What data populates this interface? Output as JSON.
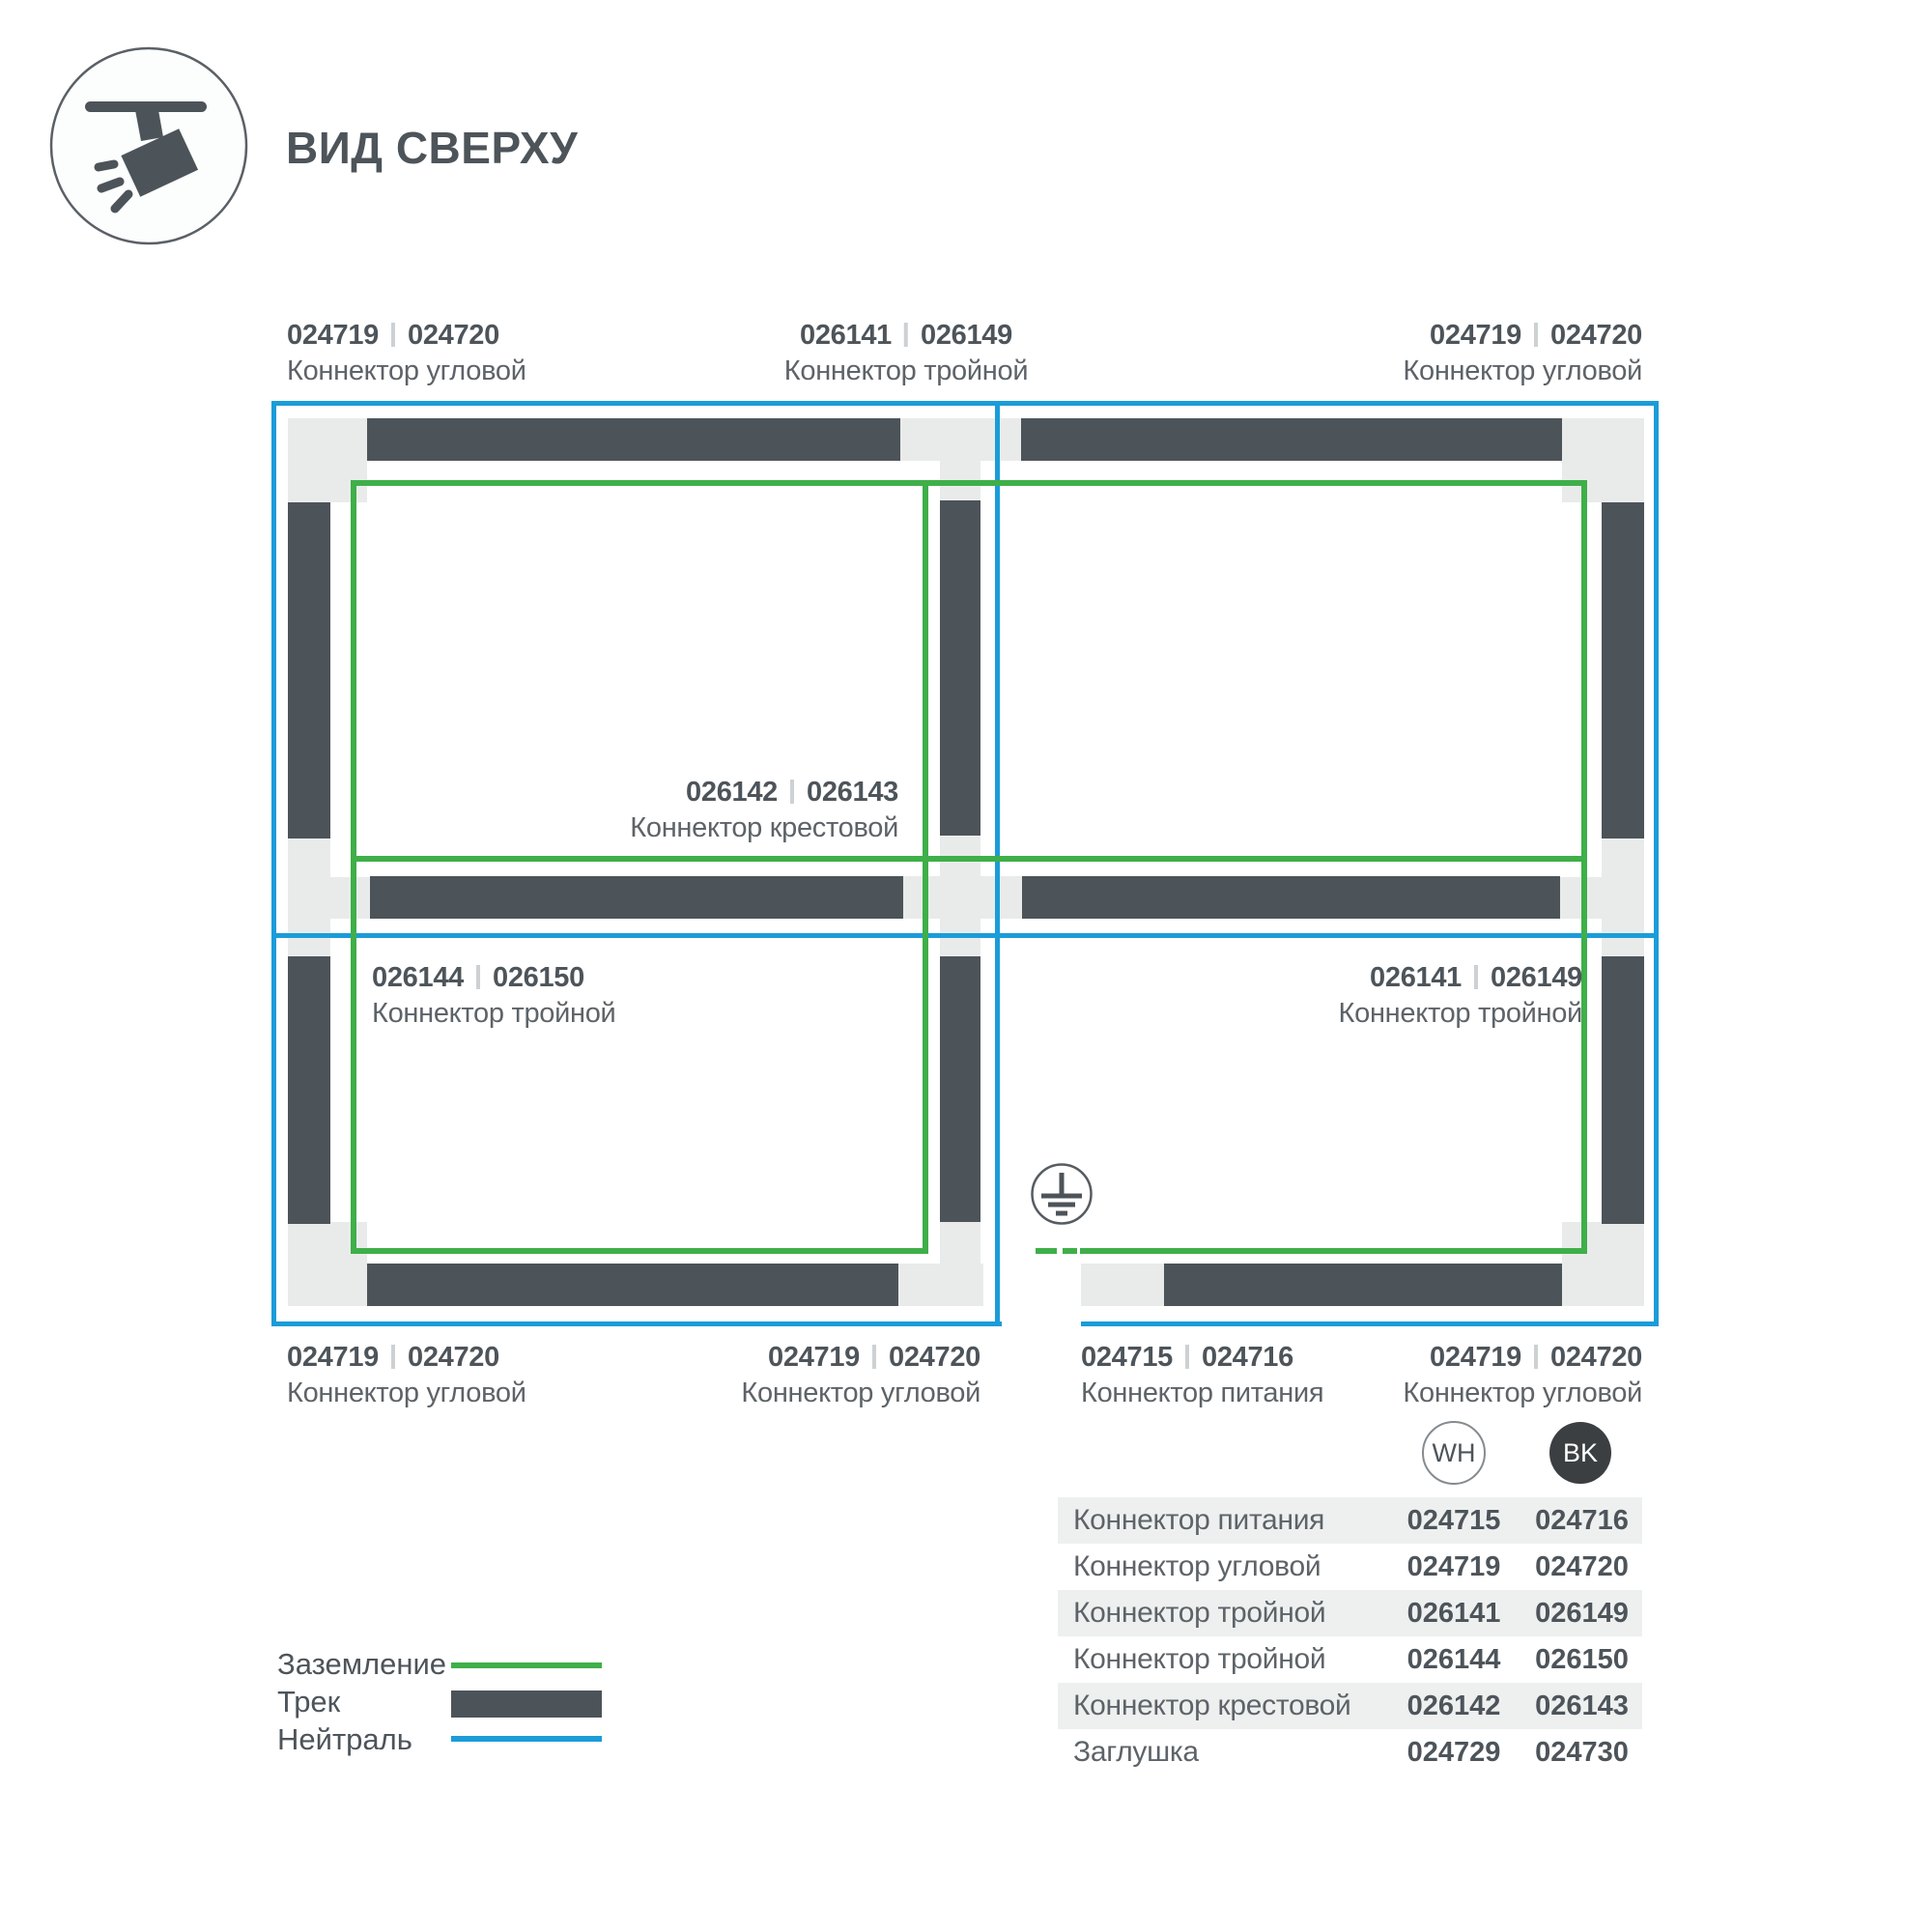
{
  "header": {
    "title": "ВИД СВЕРХУ"
  },
  "icons": {
    "header_icon": "track-spotlight-icon",
    "ground_icon": "protective-earth-icon"
  },
  "colors": {
    "track": "#4d5459",
    "connector_block": "#e9ebeb",
    "ground_green": "#3faf49",
    "neutral_blue": "#1b9cd8",
    "text_dark": "#4d545a",
    "text_caption": "#5d6368",
    "table_row_bg": "#eef0f0",
    "bk_circle_fill": "#3b3f42"
  },
  "diagram": {
    "labels": [
      {
        "codes": [
          "024719",
          "024720"
        ],
        "name": "Коннектор угловой"
      },
      {
        "codes": [
          "026141",
          "026149"
        ],
        "name": "Коннектор тройной"
      },
      {
        "codes": [
          "024719",
          "024720"
        ],
        "name": "Коннектор угловой"
      },
      {
        "codes": [
          "026142",
          "026143"
        ],
        "name": "Коннектор крестовой"
      },
      {
        "codes": [
          "026144",
          "026150"
        ],
        "name": "Коннектор тройной"
      },
      {
        "codes": [
          "026141",
          "026149"
        ],
        "name": "Коннектор тройной"
      },
      {
        "codes": [
          "024719",
          "024720"
        ],
        "name": "Коннектор угловой"
      },
      {
        "codes": [
          "024719",
          "024720"
        ],
        "name": "Коннектор угловой"
      },
      {
        "codes": [
          "024715",
          "024716"
        ],
        "name": "Коннектор питания"
      },
      {
        "codes": [
          "024719",
          "024720"
        ],
        "name": "Коннектор угловой"
      }
    ]
  },
  "legend": {
    "items": [
      {
        "label": "Заземление",
        "swatch": "ground-line"
      },
      {
        "label": "Трек",
        "swatch": "track-bar"
      },
      {
        "label": "Нейтраль",
        "swatch": "neutral-line"
      }
    ]
  },
  "table": {
    "columns": [
      {
        "id": "WH"
      },
      {
        "id": "BK"
      }
    ],
    "rows": [
      {
        "name": "Коннектор питания",
        "wh": "024715",
        "bk": "024716"
      },
      {
        "name": "Коннектор угловой",
        "wh": "024719",
        "bk": "024720"
      },
      {
        "name": "Коннектор тройной",
        "wh": "026141",
        "bk": "026149"
      },
      {
        "name": "Коннектор тройной",
        "wh": "026144",
        "bk": "026150"
      },
      {
        "name": "Коннектор крестовой",
        "wh": "026142",
        "bk": "026143"
      },
      {
        "name": "Заглушка",
        "wh": "024729",
        "bk": "024730"
      }
    ]
  }
}
